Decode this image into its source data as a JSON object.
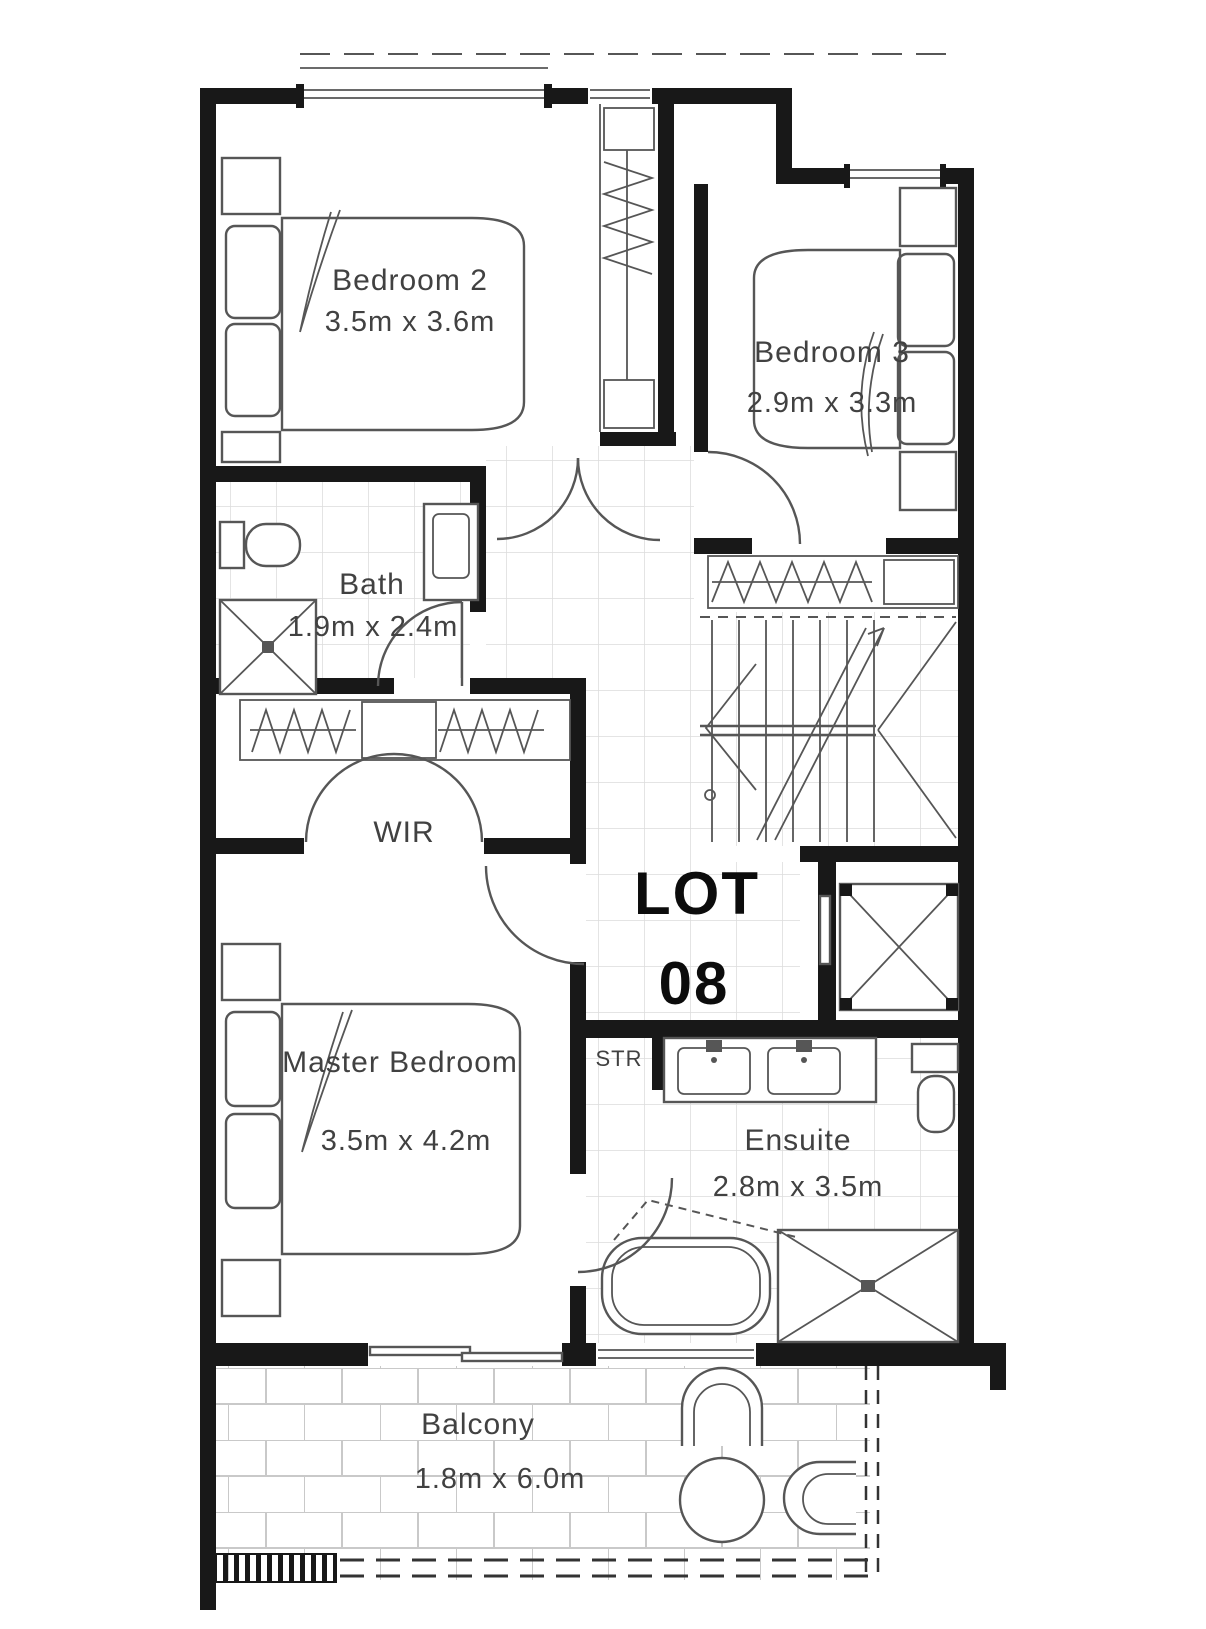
{
  "title": "Floor plan",
  "lot": {
    "line1": "LOT",
    "line2": "08"
  },
  "rooms": {
    "bedroom2": {
      "name": "Bedroom 2",
      "dims": "3.5m x 3.6m"
    },
    "bedroom3": {
      "name": "Bedroom 3",
      "dims": "2.9m x 3.3m"
    },
    "bath": {
      "name": "Bath",
      "dims": "1.9m x 2.4m"
    },
    "wir": {
      "name": "WIR"
    },
    "master_bedroom": {
      "name": "Master Bedroom",
      "dims": "3.5m x 4.2m"
    },
    "ensuite": {
      "name": "Ensuite",
      "dims": "2.8m x 3.5m"
    },
    "stair_store": {
      "name": "STR"
    },
    "balcony": {
      "name": "Balcony",
      "dims": "1.8m x 6.0m"
    }
  },
  "colors": {
    "wall": "#181818",
    "line": "#565656",
    "label": "#414141",
    "lot": "#0c0c0c",
    "grid": "#dcdcdc",
    "brick": "#c9c9c9"
  }
}
